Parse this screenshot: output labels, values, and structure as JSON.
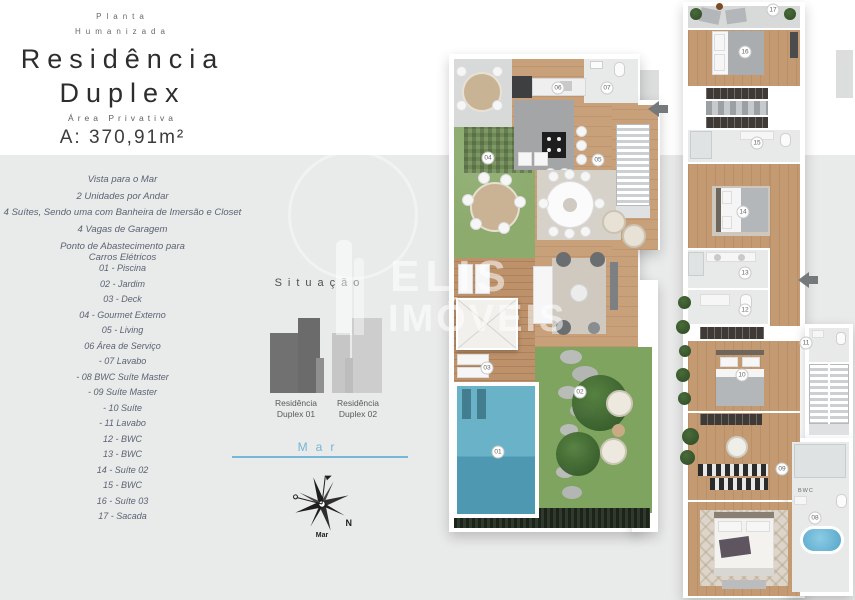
{
  "header": {
    "eyebrow_line1": "Planta",
    "eyebrow_line2": "Humanizada",
    "title_line1": "Residência",
    "title_line2": "Duplex",
    "area_label": "Área Privativa",
    "area_value": "A: 370,91m²"
  },
  "features": {
    "items": [
      "Vista para o Mar",
      "2 Unidades por Andar",
      "4 Suítes, Sendo uma com Banheira de Imersão e Closet",
      "4 Vagas de Garagem",
      "Ponto de Abastecimento para\nCarros Elétricos"
    ]
  },
  "legend": {
    "items": [
      "01 - Piscina",
      "02 - Jardim",
      "03 - Deck",
      "04 - Gourmet Externo",
      "05 - Living",
      "06 Área de Serviço",
      "- 07 Lavabo",
      "- 08 BWC Suíte Master",
      "- 09 Suíte Master",
      "- 10 Suíte",
      "- 11 Lavabo",
      "12 - BWC",
      "13 - BWC",
      "14 - Suíte 02",
      "15 - BWC",
      "16 - Suíte 03",
      "17 - Sacada"
    ]
  },
  "situacao": {
    "title": "Situação",
    "buildings": [
      {
        "name": "Residência\nDuplex 01"
      },
      {
        "name": "Residência\nDuplex 02"
      }
    ],
    "sea_label": "Mar"
  },
  "compass": {
    "north_label": "N",
    "sea_label": "Mar"
  },
  "watermark": {
    "line1": "ELIS",
    "line2": "IMÓVEIS"
  },
  "colors": {
    "accent_blue": "#74b6d8",
    "building_dark": "#6f6f6f",
    "building_light": "#c9c9c9"
  },
  "plans": {
    "left": {
      "markers": [
        {
          "n": "01",
          "x": 498,
          "y": 452
        },
        {
          "n": "02",
          "x": 580,
          "y": 392
        },
        {
          "n": "03",
          "x": 487,
          "y": 368
        },
        {
          "n": "04",
          "x": 488,
          "y": 158
        },
        {
          "n": "05",
          "x": 598,
          "y": 160
        },
        {
          "n": "06",
          "x": 558,
          "y": 88
        },
        {
          "n": "07",
          "x": 607,
          "y": 88
        }
      ]
    },
    "right": {
      "bwc_text": "BWC",
      "markers": [
        {
          "n": "08",
          "x": 815,
          "y": 518
        },
        {
          "n": "09",
          "x": 782,
          "y": 469
        },
        {
          "n": "10",
          "x": 742,
          "y": 375
        },
        {
          "n": "11",
          "x": 806,
          "y": 343
        },
        {
          "n": "12",
          "x": 745,
          "y": 310
        },
        {
          "n": "13",
          "x": 745,
          "y": 273
        },
        {
          "n": "14",
          "x": 743,
          "y": 212
        },
        {
          "n": "15",
          "x": 757,
          "y": 143
        },
        {
          "n": "16",
          "x": 745,
          "y": 52
        },
        {
          "n": "17",
          "x": 773,
          "y": 10
        }
      ]
    }
  }
}
